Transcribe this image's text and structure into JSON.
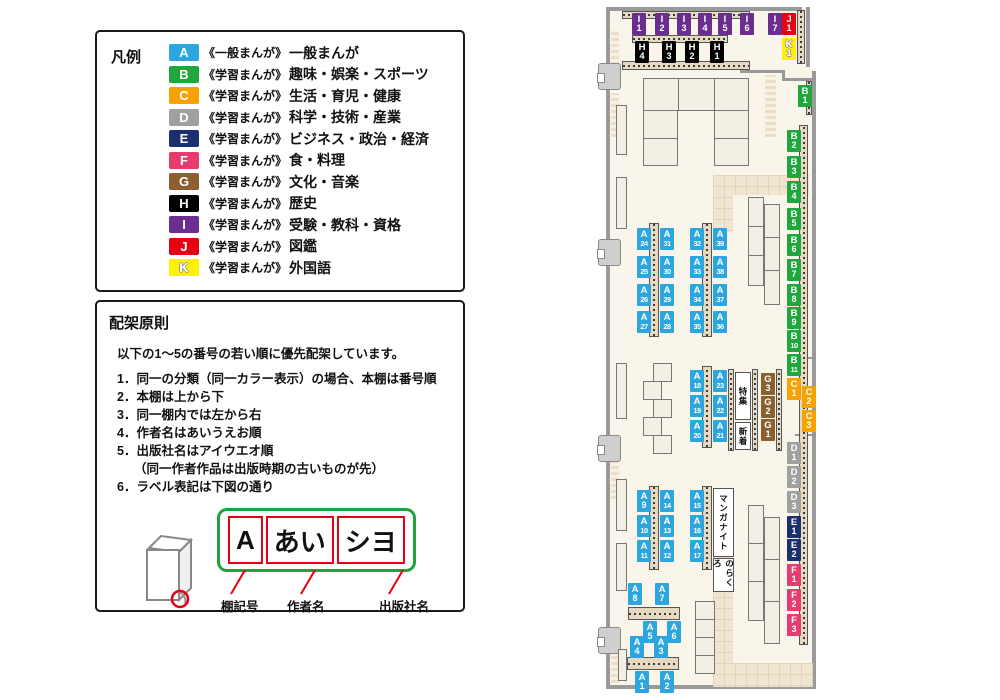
{
  "legend": {
    "title": "凡例",
    "items": [
      {
        "code": "A",
        "color": "#2BA6DE",
        "series": "《一般まんが》",
        "name": "一般まんが"
      },
      {
        "code": "B",
        "color": "#1EA73C",
        "series": "《学習まんが》",
        "name": "趣味・娯楽・スポーツ"
      },
      {
        "code": "C",
        "color": "#F6A200",
        "series": "《学習まんが》",
        "name": "生活・育児・健康"
      },
      {
        "code": "D",
        "color": "#9FA0A0",
        "series": "《学習まんが》",
        "name": "科学・技術・産業"
      },
      {
        "code": "E",
        "color": "#1C2F6E",
        "series": "《学習まんが》",
        "name": "ビジネス・政治・経済"
      },
      {
        "code": "F",
        "color": "#E73A6E",
        "series": "《学習まんが》",
        "name": "食・料理"
      },
      {
        "code": "G",
        "color": "#8C5F2E",
        "series": "《学習まんが》",
        "name": "文化・音楽"
      },
      {
        "code": "H",
        "color": "#000000",
        "series": "《学習まんが》",
        "name": "歴史"
      },
      {
        "code": "I",
        "color": "#6C2D91",
        "series": "《学習まんが》",
        "name": "受験・教科・資格"
      },
      {
        "code": "J",
        "color": "#E60012",
        "series": "《学習まんが》",
        "name": "図鑑"
      },
      {
        "code": "K",
        "color": "#FFF100",
        "series": "《学習まんが》",
        "name": "外国語"
      }
    ]
  },
  "rules": {
    "title": "配架原則",
    "intro": "以下の1〜5の番号の若い順に優先配架しています。",
    "items": [
      {
        "num": "1．",
        "text": "同一の分類（同一カラー表示）の場合、本棚は番号順"
      },
      {
        "num": "2．",
        "text": "本棚は上から下"
      },
      {
        "num": "3．",
        "text": "同一棚内では左から右"
      },
      {
        "num": "4．",
        "text": "作者名はあいうえお順"
      },
      {
        "num": "5．",
        "text": "出版社名はアイウエオ順",
        "note": "（同一作者作品は出版時期の古いものが先）"
      },
      {
        "num": "6．",
        "text": "ラベル表記は下図の通り"
      }
    ]
  },
  "label_diagram": {
    "cells": [
      {
        "text": "A",
        "caption": "棚記号",
        "caption_left": 32
      },
      {
        "text": "あい",
        "caption": "作者名",
        "caption_left": 98
      },
      {
        "text": "シヨ",
        "caption": "出版社名",
        "caption_left": 190
      }
    ]
  },
  "map": {
    "colors": {
      "A": "#2BA6DE",
      "B": "#1EA73C",
      "C": "#F6A200",
      "D": "#9FA0A0",
      "E": "#1C2F6E",
      "F": "#E73A6E",
      "G": "#8C5F2E",
      "H": "#000000",
      "I": "#6C2D91",
      "J": "#E60012",
      "K": "#FFF100"
    },
    "labels": [
      [
        "I1",
        34,
        8
      ],
      [
        "I2",
        57,
        8
      ],
      [
        "I3",
        79,
        8
      ],
      [
        "I4",
        100,
        8
      ],
      [
        "I5",
        120,
        8
      ],
      [
        "I6",
        142,
        8
      ],
      [
        "I7",
        170,
        8
      ],
      [
        "J1",
        184,
        8
      ],
      [
        "K1",
        184,
        33
      ],
      [
        "H4",
        37,
        36
      ],
      [
        "H3",
        64,
        36
      ],
      [
        "H2",
        87,
        36
      ],
      [
        "H1",
        112,
        36
      ],
      [
        "B1",
        200,
        80
      ],
      [
        "B2",
        189,
        125
      ],
      [
        "B3",
        189,
        151
      ],
      [
        "B4",
        189,
        176
      ],
      [
        "B5",
        189,
        203
      ],
      [
        "B6",
        189,
        229
      ],
      [
        "B7",
        189,
        254
      ],
      [
        "B8",
        189,
        279
      ],
      [
        "B9",
        189,
        302
      ],
      [
        "B10",
        189,
        325
      ],
      [
        "B11",
        189,
        349
      ],
      [
        "C1",
        189,
        373
      ],
      [
        "C2",
        204,
        381
      ],
      [
        "C3",
        204,
        405
      ],
      [
        "G3",
        163,
        368
      ],
      [
        "G2",
        163,
        391
      ],
      [
        "G1",
        163,
        414
      ],
      [
        "D1",
        189,
        437
      ],
      [
        "D2",
        189,
        461
      ],
      [
        "D3",
        189,
        486
      ],
      [
        "E1",
        189,
        511
      ],
      [
        "E2",
        189,
        534
      ],
      [
        "F1",
        189,
        559
      ],
      [
        "F2",
        189,
        584
      ],
      [
        "F3",
        189,
        609
      ],
      [
        "A24",
        39,
        223
      ],
      [
        "A25",
        39,
        251
      ],
      [
        "A26",
        39,
        279
      ],
      [
        "A27",
        39,
        306
      ],
      [
        "A31",
        62,
        223
      ],
      [
        "A30",
        62,
        251
      ],
      [
        "A29",
        62,
        279
      ],
      [
        "A28",
        62,
        306
      ],
      [
        "A32",
        92,
        223
      ],
      [
        "A33",
        92,
        251
      ],
      [
        "A34",
        92,
        279
      ],
      [
        "A35",
        92,
        306
      ],
      [
        "A39",
        115,
        223
      ],
      [
        "A38",
        115,
        251
      ],
      [
        "A37",
        115,
        279
      ],
      [
        "A36",
        115,
        306
      ],
      [
        "A18",
        92,
        365
      ],
      [
        "A19",
        92,
        390
      ],
      [
        "A20",
        92,
        415
      ],
      [
        "A23",
        115,
        365
      ],
      [
        "A22",
        115,
        390
      ],
      [
        "A21",
        115,
        415
      ],
      [
        "A9",
        39,
        485
      ],
      [
        "A10",
        39,
        510
      ],
      [
        "A11",
        39,
        535
      ],
      [
        "A14",
        62,
        485
      ],
      [
        "A13",
        62,
        510
      ],
      [
        "A12",
        62,
        535
      ],
      [
        "A15",
        92,
        485
      ],
      [
        "A16",
        92,
        510
      ],
      [
        "A17",
        92,
        535
      ],
      [
        "A8",
        30,
        578
      ],
      [
        "A7",
        57,
        578
      ],
      [
        "A5",
        45,
        616
      ],
      [
        "A6",
        69,
        616
      ],
      [
        "A4",
        32,
        631
      ],
      [
        "A3",
        56,
        631
      ],
      [
        "A1",
        37,
        666
      ],
      [
        "A2",
        62,
        666
      ]
    ],
    "texts": [
      {
        "text": "特集",
        "x": 137,
        "y": 367,
        "w": 16,
        "h": 48
      },
      {
        "text": "新着",
        "x": 137,
        "y": 417,
        "w": 16,
        "h": 28
      },
      {
        "text": "マンガナイト",
        "x": 115,
        "y": 483,
        "w": 21,
        "h": 69
      },
      {
        "text": "のらくろ",
        "x": 115,
        "y": 553,
        "w": 21,
        "h": 34
      }
    ]
  }
}
